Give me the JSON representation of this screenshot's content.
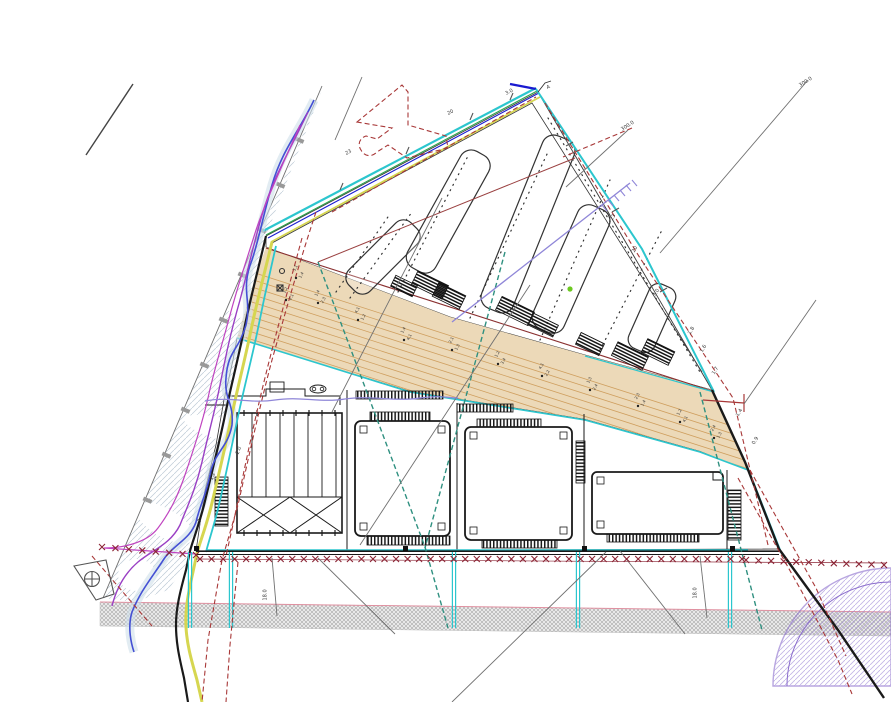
{
  "canvas": {
    "width": 891,
    "height": 702
  },
  "colors": {
    "pavement_hatch": "#c6c6c6",
    "wetland_hatch": "#b6c6d2",
    "access_road_fill": "#ecd9b8",
    "access_road_lines": "#cf9f5f",
    "boundary_cyan": "#2cc6ce",
    "boundary_blue": "#1a1ad0",
    "boundary_green": "#2aa548",
    "boundary_yellow": "#d6d650",
    "stream_blue": "#4450d4",
    "stream_purple": "#9a3fc4",
    "stream_magenta": "#c044c0",
    "utility_lavender": "#8f86d8",
    "red_dashed": "#a83838",
    "fence_red": "#8b2535",
    "teal_dashed": "#2f9080",
    "road_band_hatch": "#999999",
    "road_band_pink": "#e090a0",
    "sector_purple": "#8a6ccc",
    "survey_gray": "#707070",
    "green_point": "#6cc820",
    "ink": "#1a1a1a"
  },
  "labels": [
    {
      "t": "23",
      "x": 346,
      "y": 152,
      "r": -28
    },
    {
      "t": "20",
      "x": 448,
      "y": 112,
      "r": -28
    },
    {
      "t": "3.0",
      "x": 506,
      "y": 92,
      "r": -28
    },
    {
      "t": "A",
      "x": 547,
      "y": 86,
      "r": -20
    },
    {
      "t": "300.0",
      "x": 622,
      "y": 128,
      "r": -33
    },
    {
      "t": "300.0",
      "x": 800,
      "y": 84,
      "r": -33
    },
    {
      "t": "23",
      "x": 612,
      "y": 218,
      "r": -60
    },
    {
      "t": "20",
      "x": 634,
      "y": 250,
      "r": -60
    },
    {
      "t": "3.0",
      "x": 655,
      "y": 294,
      "r": -60
    },
    {
      "t": "1.8",
      "x": 690,
      "y": 332,
      "r": -60
    },
    {
      "t": "1.6",
      "x": 702,
      "y": 350,
      "r": -60
    },
    {
      "t": "1.7",
      "x": 714,
      "y": 372,
      "r": -60
    },
    {
      "t": "1.4",
      "x": 738,
      "y": 414,
      "r": -60
    },
    {
      "t": "0.9",
      "x": 754,
      "y": 442,
      "r": -60
    },
    {
      "t": "18.0",
      "x": 266,
      "y": 598,
      "r": -90
    },
    {
      "t": "18.0",
      "x": 696,
      "y": 596,
      "r": -90
    },
    {
      "t": "1.2",
      "x": 212,
      "y": 478,
      "r": -70
    },
    {
      "t": "2.0",
      "x": 238,
      "y": 452,
      "r": -70
    },
    {
      "t": "7",
      "x": 200,
      "y": 520,
      "r": -70
    }
  ],
  "elevation_markers": [
    {
      "x": 318,
      "y": 303,
      "a": "1.4",
      "b": "2.3"
    },
    {
      "x": 358,
      "y": 320,
      "a": "4.1",
      "b": "1.2"
    },
    {
      "x": 404,
      "y": 340,
      "a": "1.4",
      "b": "4.1"
    },
    {
      "x": 452,
      "y": 350,
      "a": "2.1",
      "b": "1.3"
    },
    {
      "x": 498,
      "y": 364,
      "a": "1.2",
      "b": "3.4"
    },
    {
      "x": 542,
      "y": 376,
      "a": "4.1",
      "b": "2.2"
    },
    {
      "x": 590,
      "y": 390,
      "a": "1.3",
      "b": "2.4"
    },
    {
      "x": 638,
      "y": 406,
      "a": "2.3",
      "b": "1.4"
    },
    {
      "x": 680,
      "y": 422,
      "a": "1.2",
      "b": "4.1"
    },
    {
      "x": 714,
      "y": 438,
      "a": "2.4",
      "b": "1.3"
    },
    {
      "x": 286,
      "y": 300,
      "a": "1.2",
      "b": "2.1"
    },
    {
      "x": 296,
      "y": 278,
      "a": "3.1",
      "b": "1.4"
    }
  ],
  "fences": [
    {
      "x1": 200,
      "y1": 559,
      "x2": 742,
      "y2": 559,
      "n": 48
    },
    {
      "x1": 746,
      "y1": 560,
      "x2": 884,
      "y2": 565,
      "n": 12
    },
    {
      "x1": 102,
      "y1": 547,
      "x2": 196,
      "y2": 555,
      "n": 8
    }
  ]
}
